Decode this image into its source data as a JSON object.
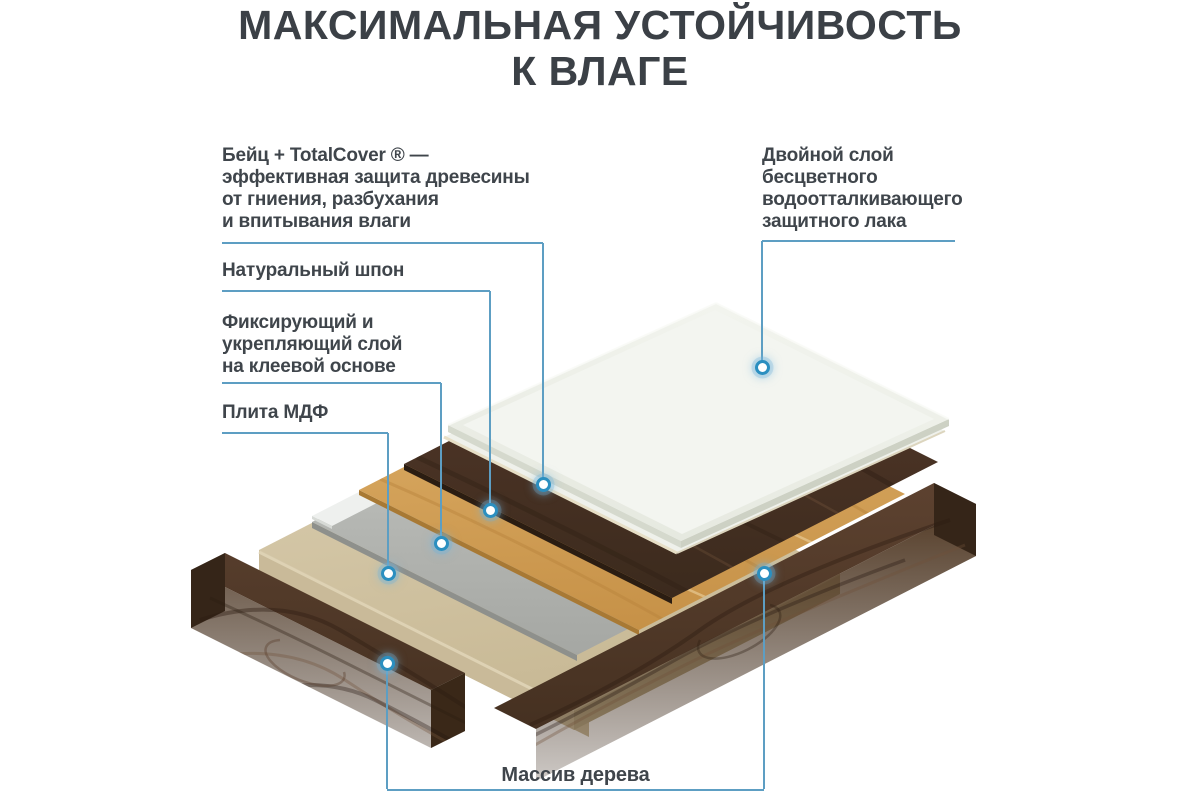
{
  "title": {
    "line1": "МАКСИМАЛЬНАЯ УСТОЙЧИВОСТЬ",
    "line2": "К ВЛАГЕ"
  },
  "labels": {
    "stain": {
      "lines": [
        "Бейц + TotalCover ® —",
        "эффективная защита древесины",
        "от гниения, разбухания",
        "и впитывания влаги"
      ]
    },
    "veneer": {
      "text": "Натуральный шпон"
    },
    "adhesive": {
      "lines": [
        "Фиксирующий и",
        "укрепляющий слой",
        "на клеевой основе"
      ]
    },
    "mdf": {
      "text": "Плита МДФ"
    },
    "lacquer": {
      "lines": [
        "Двойной слой",
        "бесцветного",
        "водоотталкивающего",
        "защитного лака"
      ]
    },
    "solid_wood": {
      "text": "Массив дерева"
    }
  },
  "diagram": {
    "layers": [
      {
        "id": "lacquer-panel",
        "label": "Двойной слой бесцветного водоотталкивающего защитного лака",
        "color": "#eef0ea"
      },
      {
        "id": "stained-veneer",
        "label": "Бейц + TotalCover ®",
        "color": "#4a3525"
      },
      {
        "id": "natural-veneer",
        "label": "Натуральный шпон",
        "color": "#d3a05a"
      },
      {
        "id": "adhesive-layer",
        "label": "Фиксирующий и укрепляющий слой на клеевой основе",
        "color": "#b3b5b1"
      },
      {
        "id": "mdf-board",
        "label": "Плита МДФ",
        "color": "#cfc2a2"
      },
      {
        "id": "solid-wood-frame",
        "label": "Массив дерева",
        "color": "#46311f"
      }
    ],
    "colors": {
      "leader_line": "#5d9ec3",
      "dot_ring": "#2b8fc0",
      "dot_fill": "#ffffff",
      "title_text": "#3b4046",
      "label_text": "#3f454b"
    }
  }
}
